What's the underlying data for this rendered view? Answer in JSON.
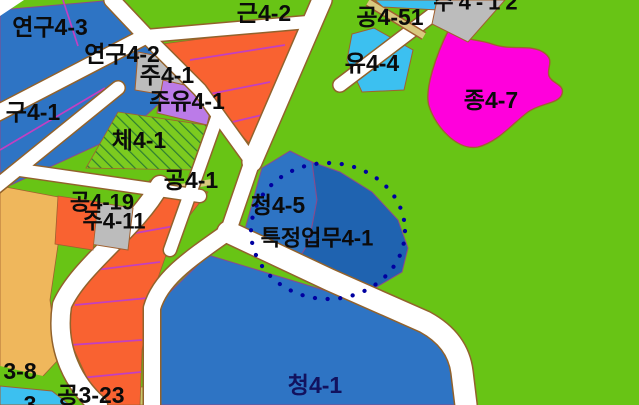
{
  "map": {
    "type": "korean-zoning-district-map",
    "labels": {
      "y43": "연구4-3",
      "y42": "연구4-2",
      "gu41": "구4-1",
      "ju41": "주4-1",
      "juyu41": "주유4-1",
      "che41": "체4-1",
      "gong41": "공4-1",
      "gong419": "공4-19",
      "ju411": "주4-11",
      "geun42": "근4-2",
      "gong451": "공4-51",
      "yu44": "유4-4",
      "jong47": "종4-7",
      "ju412_partial": "주4-12",
      "cheong45": "청4-5",
      "teukjeong41": "특정업무4-1",
      "cheong41": "청4-1",
      "gong323": "공3-23",
      "gong38_partial": "3-8",
      "bottom_left_partial": "3"
    },
    "colors": {
      "background_green": "#68C415",
      "parcel_blue": "#2E74C4",
      "parcel_blue_dark": "#1F63B0",
      "orange": "#F96231",
      "sand": "#EFB75C",
      "gray": "#BCBCBC",
      "violet": "#BB7BE8",
      "magenta": "#FF00DC",
      "cyan": "#3CC0F0",
      "khaki": "#D9C97E",
      "olive": "#C8C86A",
      "road_white": "#FFFFFF",
      "road_border": "#92622C",
      "parcel_division": "#C23FC2",
      "dotted_circle": "#0000A0",
      "label_text": "#0B0B0B",
      "label_text_navy": "#12125E"
    },
    "annotations": {
      "dotted_circle_style": "dotted"
    }
  }
}
